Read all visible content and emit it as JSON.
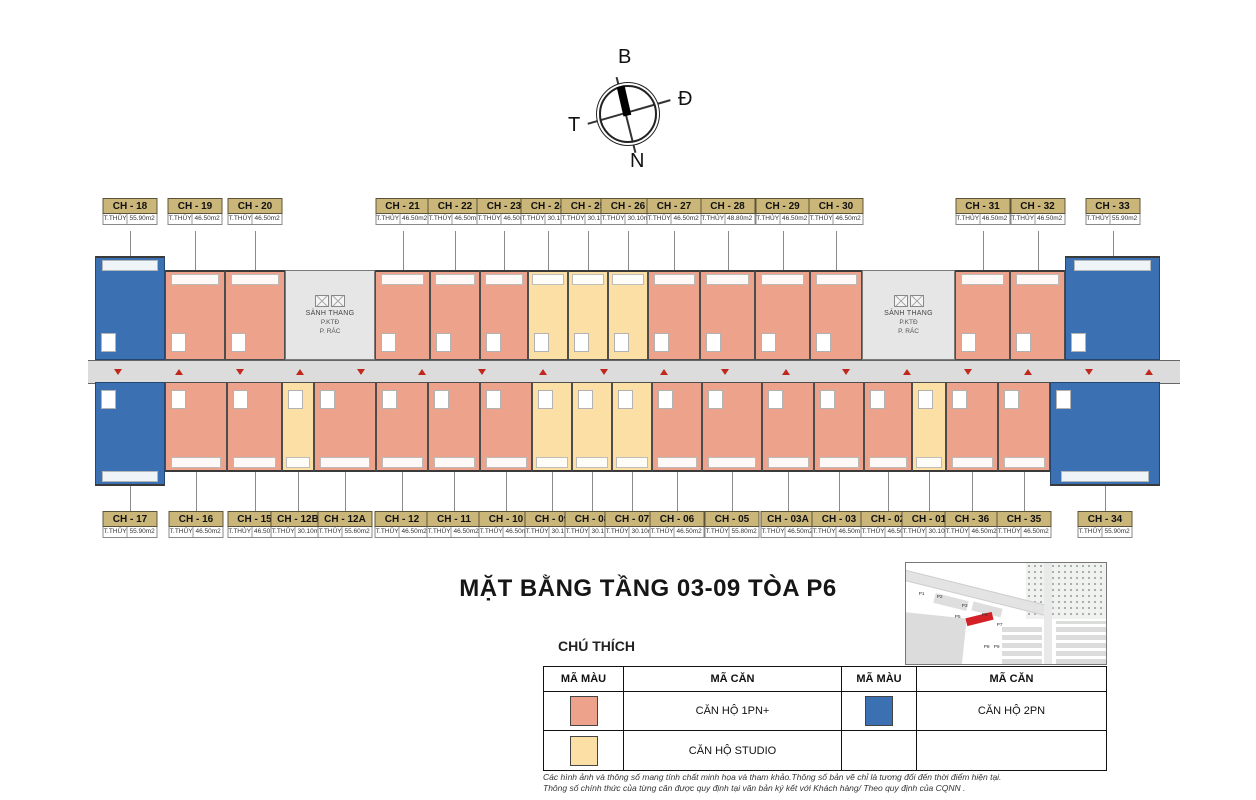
{
  "compass": {
    "north": "B",
    "east": "Đ",
    "south": "N",
    "west": "T"
  },
  "title": "MẶT BẰNG TẦNG 03-09 TÒA P6",
  "legend": {
    "heading": "CHÚ THÍCH",
    "col_headers": [
      "MÃ MÀU",
      "MÃ CĂN",
      "MÃ MÀU",
      "MÃ CĂN"
    ],
    "entries": [
      {
        "label": "CĂN HỘ 1PN+",
        "color": "#EDA28C"
      },
      {
        "label": "CĂN HỘ 2PN",
        "color": "#3B70B3"
      },
      {
        "label": "CĂN HỘ STUDIO",
        "color": "#FBDFA4"
      }
    ]
  },
  "disclaimer": [
    "Các hình ảnh và thông số mang tính chất minh họa và tham khảo.Thông số bản vẽ chỉ là tương đối đến thời điểm hiện tại.",
    "Thông số chính thức của từng căn được quy định tại văn bản ký kết với Khách hàng/ Theo quy định của CQNN ."
  ],
  "minimap": {
    "labels": [
      "P1",
      "P2",
      "P3",
      "P5",
      "P6",
      "P7",
      "P8",
      "P9"
    ],
    "highlight": "P6",
    "highlight_color": "#D42127"
  },
  "floor_plan": {
    "area_prefix": "T.THỦY",
    "corridor_marker_count": 18,
    "core_labels": {
      "lobby": "SẢNH THANG",
      "tech": "P.KTĐ",
      "trash": "P. RÁC"
    },
    "top_row": [
      {
        "code": "CH - 18",
        "area": "55.90m2",
        "type": "2pn"
      },
      {
        "code": "CH - 19",
        "area": "46.50m2",
        "type": "1pn"
      },
      {
        "code": "CH - 20",
        "area": "46.50m2",
        "type": "1pn"
      },
      {
        "type": "core",
        "side": "left"
      },
      {
        "code": "CH - 21",
        "area": "46.50m2",
        "type": "1pn"
      },
      {
        "code": "CH - 22",
        "area": "46.50m2",
        "type": "1pn"
      },
      {
        "code": "CH - 23",
        "area": "46.50m2",
        "type": "1pn"
      },
      {
        "code": "CH - 24",
        "area": "30.10m2",
        "type": "studio"
      },
      {
        "code": "CH - 25",
        "area": "30.10m2",
        "type": "studio"
      },
      {
        "code": "CH - 26",
        "area": "30.10m2",
        "type": "studio"
      },
      {
        "code": "CH - 27",
        "area": "46.50m2",
        "type": "1pn"
      },
      {
        "code": "CH - 28",
        "area": "48.80m2",
        "type": "1pn"
      },
      {
        "code": "CH - 29",
        "area": "46.50m2",
        "type": "1pn"
      },
      {
        "code": "CH - 30",
        "area": "46.50m2",
        "type": "1pn"
      },
      {
        "type": "core",
        "side": "right"
      },
      {
        "code": "CH - 31",
        "area": "46.50m2",
        "type": "1pn"
      },
      {
        "code": "CH - 32",
        "area": "46.50m2",
        "type": "1pn"
      },
      {
        "code": "CH - 33",
        "area": "55.90m2",
        "type": "2pn"
      }
    ],
    "bottom_row": [
      {
        "code": "CH - 17",
        "area": "55.90m2",
        "type": "2pn"
      },
      {
        "code": "CH - 16",
        "area": "46.50m2",
        "type": "1pn"
      },
      {
        "code": "CH - 15",
        "area": "46.50m2",
        "type": "1pn"
      },
      {
        "code": "CH - 12B",
        "area": "30.10m2",
        "type": "studio"
      },
      {
        "code": "CH - 12A",
        "area": "55.60m2",
        "type": "1pn"
      },
      {
        "code": "CH - 12",
        "area": "46.50m2",
        "type": "1pn"
      },
      {
        "code": "CH - 11",
        "area": "46.50m2",
        "type": "1pn"
      },
      {
        "code": "CH - 10",
        "area": "46.50m2",
        "type": "1pn"
      },
      {
        "code": "CH - 09",
        "area": "30.10m2",
        "type": "studio"
      },
      {
        "code": "CH - 08",
        "area": "30.10m2",
        "type": "studio"
      },
      {
        "code": "CH - 07",
        "area": "30.10m2",
        "type": "studio"
      },
      {
        "code": "CH - 06",
        "area": "46.50m2",
        "type": "1pn"
      },
      {
        "code": "CH - 05",
        "area": "55.80m2",
        "type": "1pn"
      },
      {
        "code": "CH - 03A",
        "area": "46.50m2",
        "type": "1pn"
      },
      {
        "code": "CH - 03",
        "area": "46.50m2",
        "type": "1pn"
      },
      {
        "code": "CH - 02",
        "area": "46.50m2",
        "type": "1pn"
      },
      {
        "code": "CH - 01",
        "area": "30.10m2",
        "type": "studio"
      },
      {
        "code": "CH - 36",
        "area": "46.50m2",
        "type": "1pn"
      },
      {
        "code": "CH - 35",
        "area": "46.50m2",
        "type": "1pn"
      },
      {
        "code": "CH - 34",
        "area": "55.90m2",
        "type": "2pn"
      }
    ]
  }
}
